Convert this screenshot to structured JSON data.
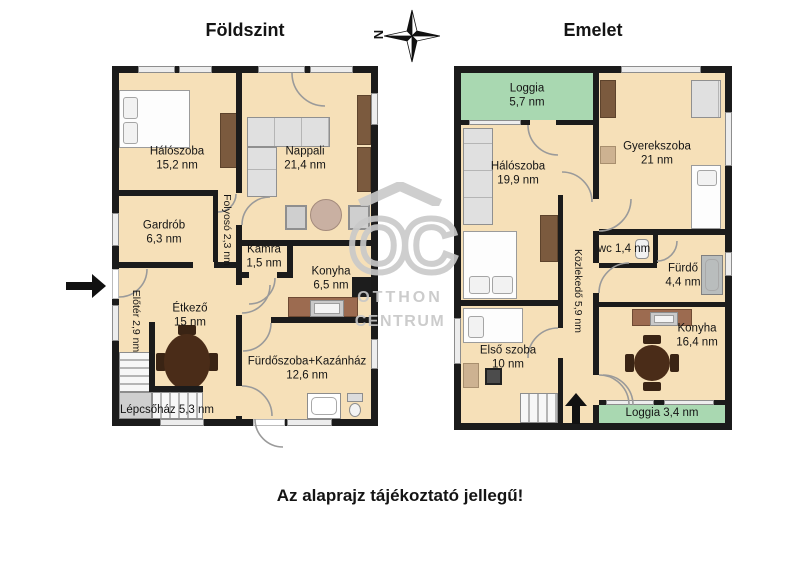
{
  "titles": {
    "ground_floor": "Földszint",
    "upper_floor": "Emelet"
  },
  "compass": {
    "north_label": "N"
  },
  "footer": {
    "disclaimer": "Az alaprajz tájékoztató jellegű!"
  },
  "watermark": {
    "monogram": "OC",
    "brand_line1": "OTTHON",
    "brand_line2": "CENTRUM"
  },
  "colors": {
    "floor": "#f6e0b8",
    "loggia_green": "#a9d8b1",
    "wall": "#1b1b1b",
    "watermark_gray": "#c9c9c9",
    "furniture_brown": "#7b5a3e",
    "counter_brown": "#9c6b50",
    "table_dark": "#4a2c18"
  },
  "ground_floor": {
    "rooms": {
      "haloszoba": {
        "name": "Hálószoba",
        "area": "15,2 nm"
      },
      "nappali": {
        "name": "Nappali",
        "area": "21,4 nm"
      },
      "gardrob": {
        "name": "Gardrób",
        "area": "6,3 nm"
      },
      "folyoso": {
        "label": "Folyosó 2,3 nm"
      },
      "kamra": {
        "name": "Kamra",
        "area": "1,5 nm"
      },
      "konyha": {
        "name": "Konyha",
        "area": "6,5 nm"
      },
      "eloter": {
        "label": "Előtér 2,9 nm"
      },
      "etkezo": {
        "name": "Étkező",
        "area": "15 nm"
      },
      "furdoszoba": {
        "name": "Fürdőszoba+Kazánház",
        "area": "12,6 nm"
      },
      "lepcsohaz": {
        "label": "Lépcsőház 5,3 nm"
      }
    }
  },
  "upper_floor": {
    "rooms": {
      "loggia_felso": {
        "name": "Loggia",
        "area": "5,7 nm"
      },
      "haloszoba": {
        "name": "Hálószoba",
        "area": "19,9 nm"
      },
      "gyerekszoba": {
        "name": "Gyerekszoba",
        "area": "21 nm"
      },
      "wc": {
        "label": "wc 1,4 nm"
      },
      "furdo": {
        "name": "Fürdő",
        "area": "4,4 nm"
      },
      "kozlekedo": {
        "label": "Közlekedő 5,9 nm"
      },
      "elso_szoba": {
        "name": "Első szoba",
        "area": "10 nm"
      },
      "konyha": {
        "name": "Konyha",
        "area": "16,4 nm"
      },
      "loggia_also": {
        "label": "Loggia 3,4 nm"
      }
    }
  }
}
